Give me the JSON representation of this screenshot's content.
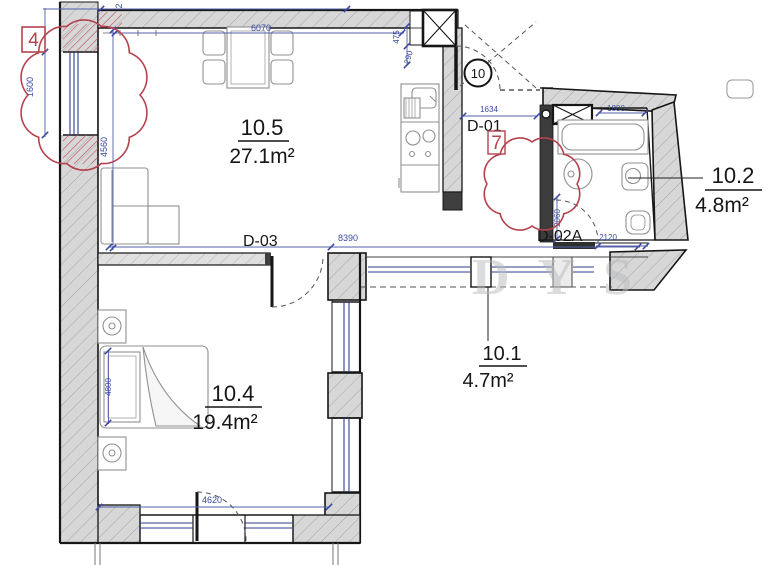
{
  "title": "apartment-floor-plan",
  "watermark": {
    "text": "DYS"
  },
  "colors": {
    "dimension_blue": "#3b4aa2",
    "revision_red": "#b5434e",
    "wall_gray": "#d7d7d7",
    "line_black": "#161616"
  },
  "rooms": {
    "living": {
      "number": "10.5",
      "area": "27.1m²"
    },
    "bedroom": {
      "number": "10.4",
      "area": "19.4m²"
    },
    "hall": {
      "number": "10.1",
      "area": "4.7m²"
    },
    "bathroom": {
      "number": "10.2",
      "area": "4.8m²"
    }
  },
  "doors": {
    "d01": "D-01",
    "d03": "D-03",
    "d02a": "D-02A",
    "entry_tag": "10"
  },
  "revisions": {
    "cloud_left": "4",
    "cloud_hall": "7"
  },
  "dimensions": {
    "top_partial": "2",
    "window_left": "1600",
    "living_depth": "4560",
    "living_width": "6070",
    "kitchen_offset_a": "475",
    "kitchen_offset_b": "290",
    "hall_width": "1634",
    "bathtub": "1800",
    "bath_door": "2120",
    "bath_depth": "2060",
    "middle_width": "8390",
    "bed_length": "4800",
    "bedroom_width": "4620"
  }
}
